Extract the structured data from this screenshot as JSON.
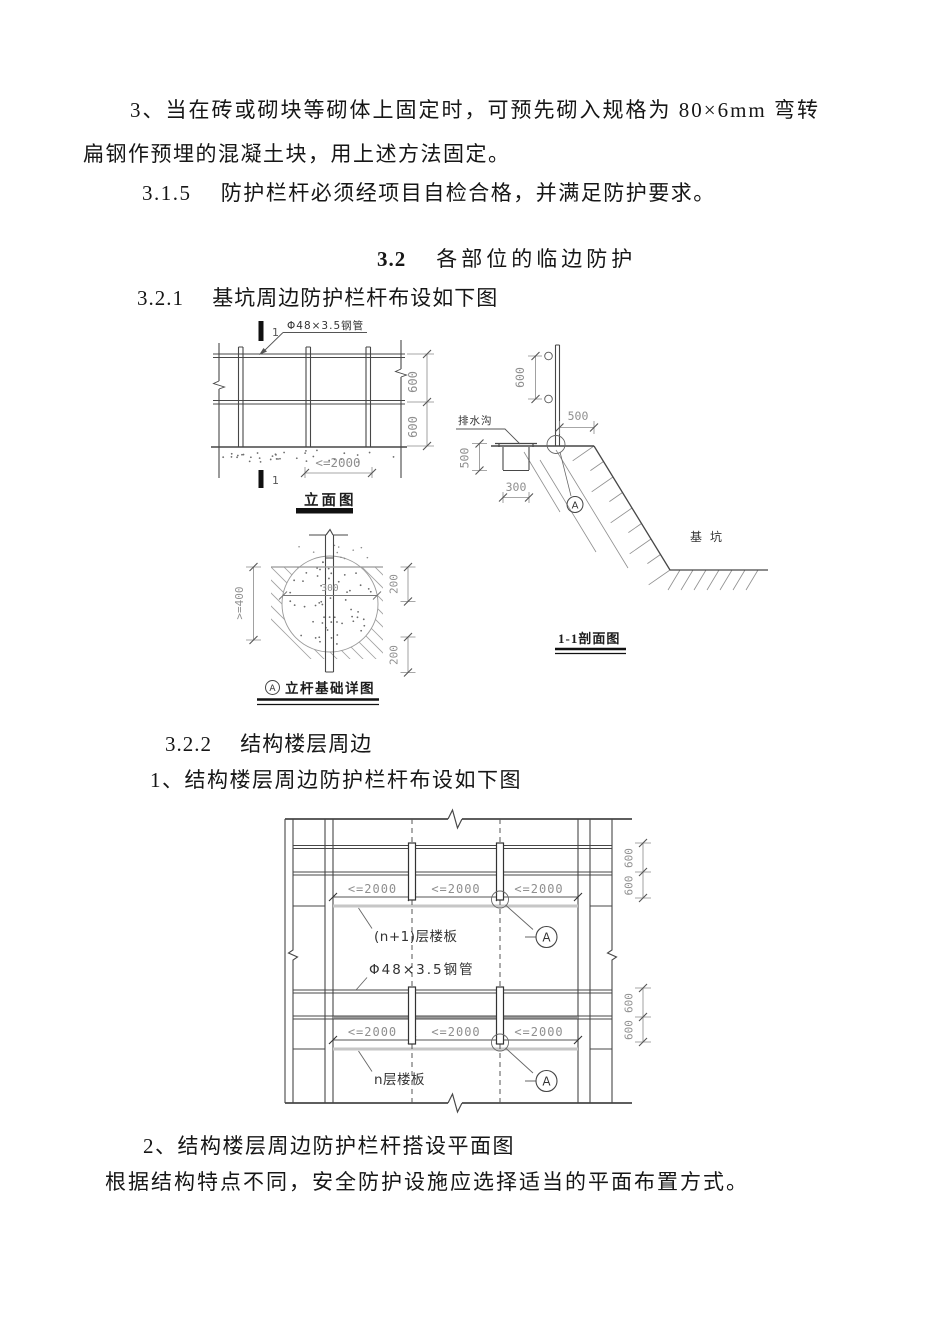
{
  "paragraphs": {
    "p1_line1": "3、当在砖或砌块等砌体上固定时，可预先砌入规格为 80×6mm 弯转",
    "p1_line2": "扁钢作预埋的混凝土块，用上述方法固定。",
    "p2": "3.1.5　 防护栏杆必须经项目自检合格，并满足防护要求。",
    "h32_num": "3.2",
    "h32_title": "各部位的临边防护",
    "s321": "3.2.1　 基坑周边防护栏杆布设如下图",
    "s322": "3.2.2　 结构楼层周边",
    "item1": "1、结构楼层周边防护栏杆布设如下图",
    "item2": "2、结构楼层周边防护栏杆搭设平面图",
    "p_last": "根据结构特点不同，安全防护设施应选择适当的平面布置方式。"
  },
  "diagram1": {
    "pipe_label": "Φ48×3.5钢管",
    "section_mark": "1",
    "dim_600": "600",
    "dim_2000": "<=2000",
    "dim_500": "500",
    "dim_300": "300",
    "dim_ge400": ">=400",
    "dim_200": "200",
    "drain_label": "排水沟",
    "pit_label": "基坑",
    "elevation_title": "立面图",
    "section_title": "1-1剖面图",
    "detail_ref": "A",
    "detail_title": "立杆基础详图"
  },
  "diagram2": {
    "dim_2000": "<=2000",
    "dim_600": "600",
    "upper_slab_label": "(n+1)层楼板",
    "pipe_label": "Φ48×3.5钢管",
    "lower_slab_label": "n层楼板",
    "detail_ref": "A"
  }
}
